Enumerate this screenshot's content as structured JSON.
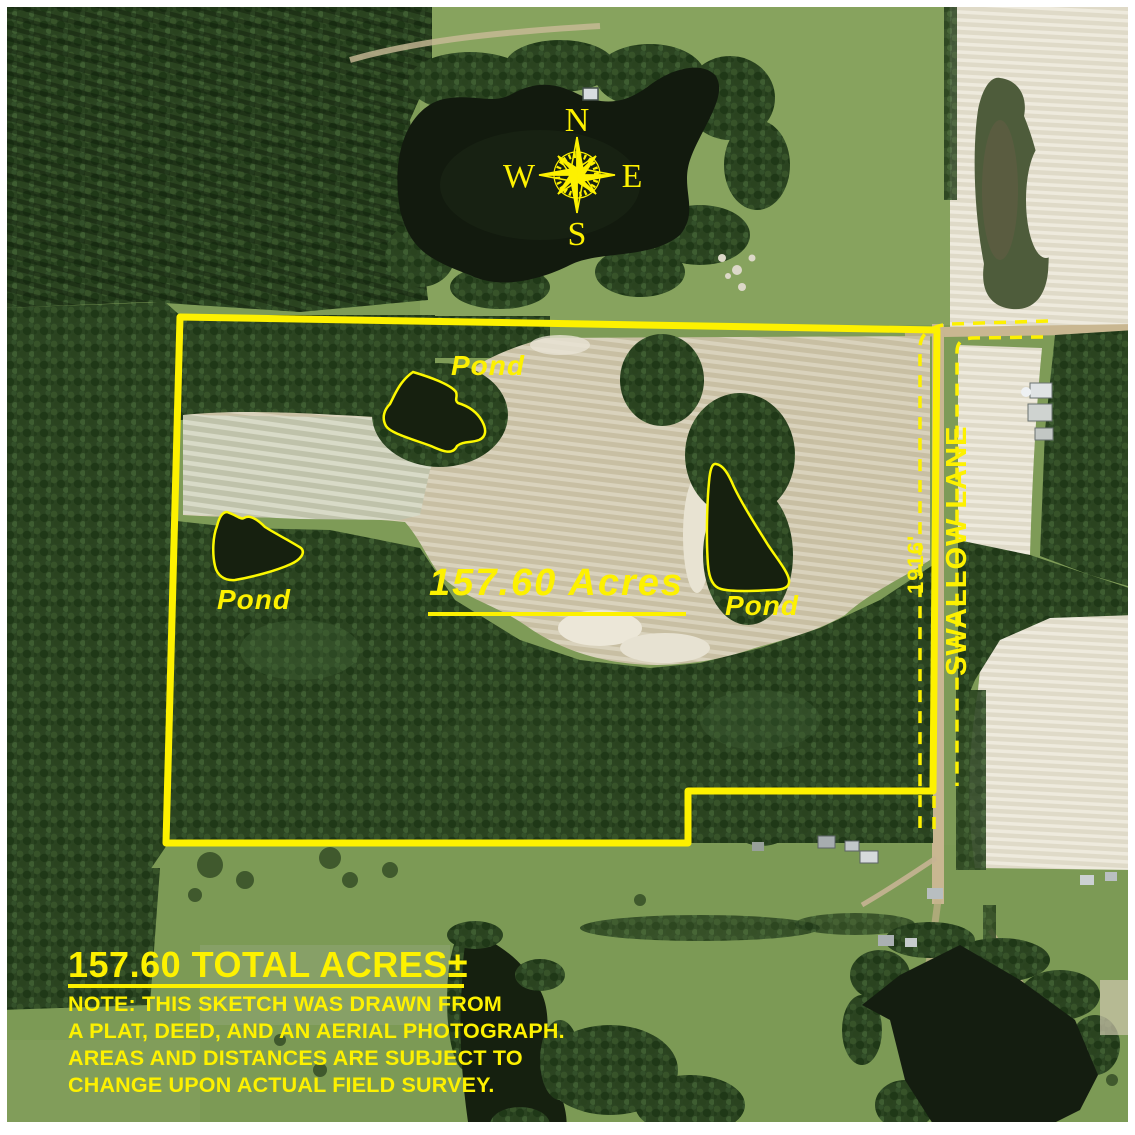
{
  "overlay": {
    "acreage_label": "157.60 Acres",
    "pond_labels": [
      "Pond",
      "Pond",
      "Pond"
    ],
    "road_name": "SWALLOW LANE",
    "road_frontage": "1916'",
    "compass": {
      "n": "N",
      "e": "E",
      "s": "S",
      "w": "W"
    }
  },
  "note": {
    "total_acres": "157.60 TOTAL ACRES±",
    "lines": [
      "NOTE: THIS SKETCH WAS DRAWN FROM",
      "A PLAT, DEED, AND AN AERIAL PHOTOGRAPH.",
      "AREAS AND DISTANCES ARE SUBJECT TO",
      "CHANGE UPON ACTUAL FIELD SURVEY."
    ]
  },
  "colors": {
    "annotation_yellow": "#fdf100",
    "forest_green": "#2b4421",
    "pasture_green": "#7e9b57",
    "field_tan": "#c8bfa3",
    "water_dark": "#141d10",
    "frame_white": "#ffffff"
  }
}
